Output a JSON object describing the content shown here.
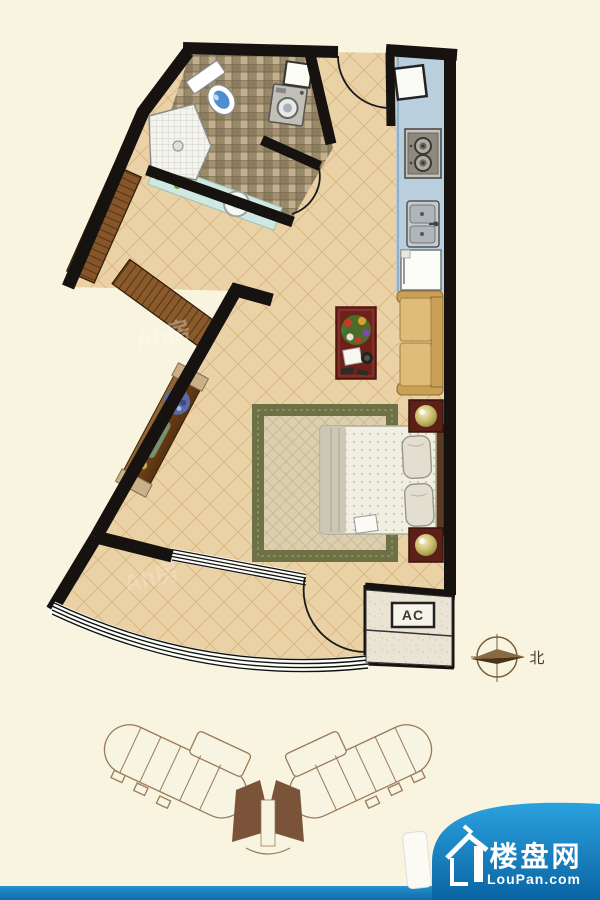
{
  "plan": {
    "type": "studio-apartment-floor-plan",
    "ac_label": "AC",
    "compass_north": "北",
    "watermark": "Ah房",
    "fixtures": [
      "toilet",
      "shower-stall",
      "vanity-basin",
      "washing-machine",
      "water-heater",
      "gas-stove",
      "double-sink",
      "fridge",
      "wardrobe",
      "console-table",
      "sofa",
      "coffee-table",
      "flower-vase",
      "double-bed",
      "pillows",
      "nightstand-lamp-top",
      "nightstand-lamp-bottom",
      "rug",
      "entry-door",
      "bathroom-door",
      "balcony-door",
      "balcony-window",
      "ac-platform"
    ]
  },
  "colors": {
    "background": "#f8f4df",
    "wall": "#151210",
    "floor_tile": "#ebd2a6",
    "kitchen_counter": "#b9cfdd",
    "bathroom_tile": "#a3916f",
    "wood": "#86562a",
    "sofa": "#d9b369",
    "table_red": "#6e211b",
    "rug_border": "#6d7145",
    "brand_blue": "#1588c6"
  },
  "logo": {
    "brand": "楼盘网",
    "domain": "LouPan.com"
  }
}
